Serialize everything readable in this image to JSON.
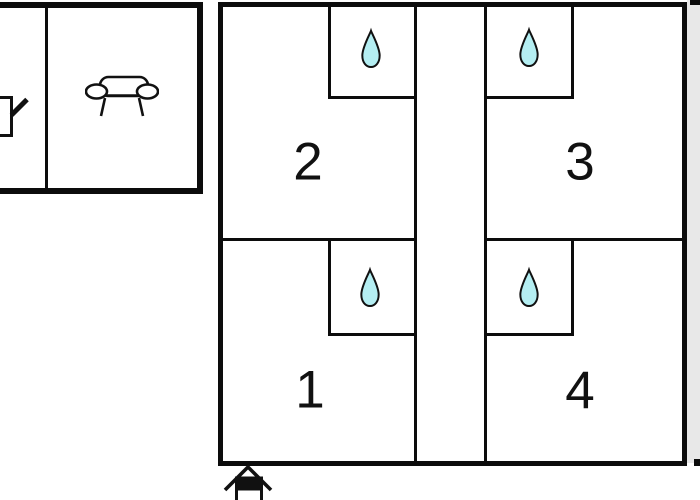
{
  "plan_title": "holiday-home-floor-plan",
  "colors": {
    "background": "#ffffff",
    "wall": "#0c0c0c",
    "drop_fill": "#b4eef2",
    "drop_outline": "#111111",
    "side_strip": "#e8e8e8"
  },
  "main_building": {
    "rooms": [
      {
        "number": "1",
        "bathroom": "water-drop-icon",
        "bathroom_corner": "top-right"
      },
      {
        "number": "2",
        "bathroom": "water-drop-icon",
        "bathroom_corner": "top-right"
      },
      {
        "number": "3",
        "bathroom": "water-drop-icon",
        "bathroom_corner": "top-left"
      },
      {
        "number": "4",
        "bathroom": "water-drop-icon",
        "bathroom_corner": "top-left"
      }
    ],
    "corridor": "central-vertical-corridor"
  },
  "annex_building": {
    "icons": [
      "sofa-icon",
      "partial-furniture-icon"
    ]
  },
  "entrance": {
    "icon": "house-entrance-icon",
    "position": "bottom-left-of-main-building"
  }
}
